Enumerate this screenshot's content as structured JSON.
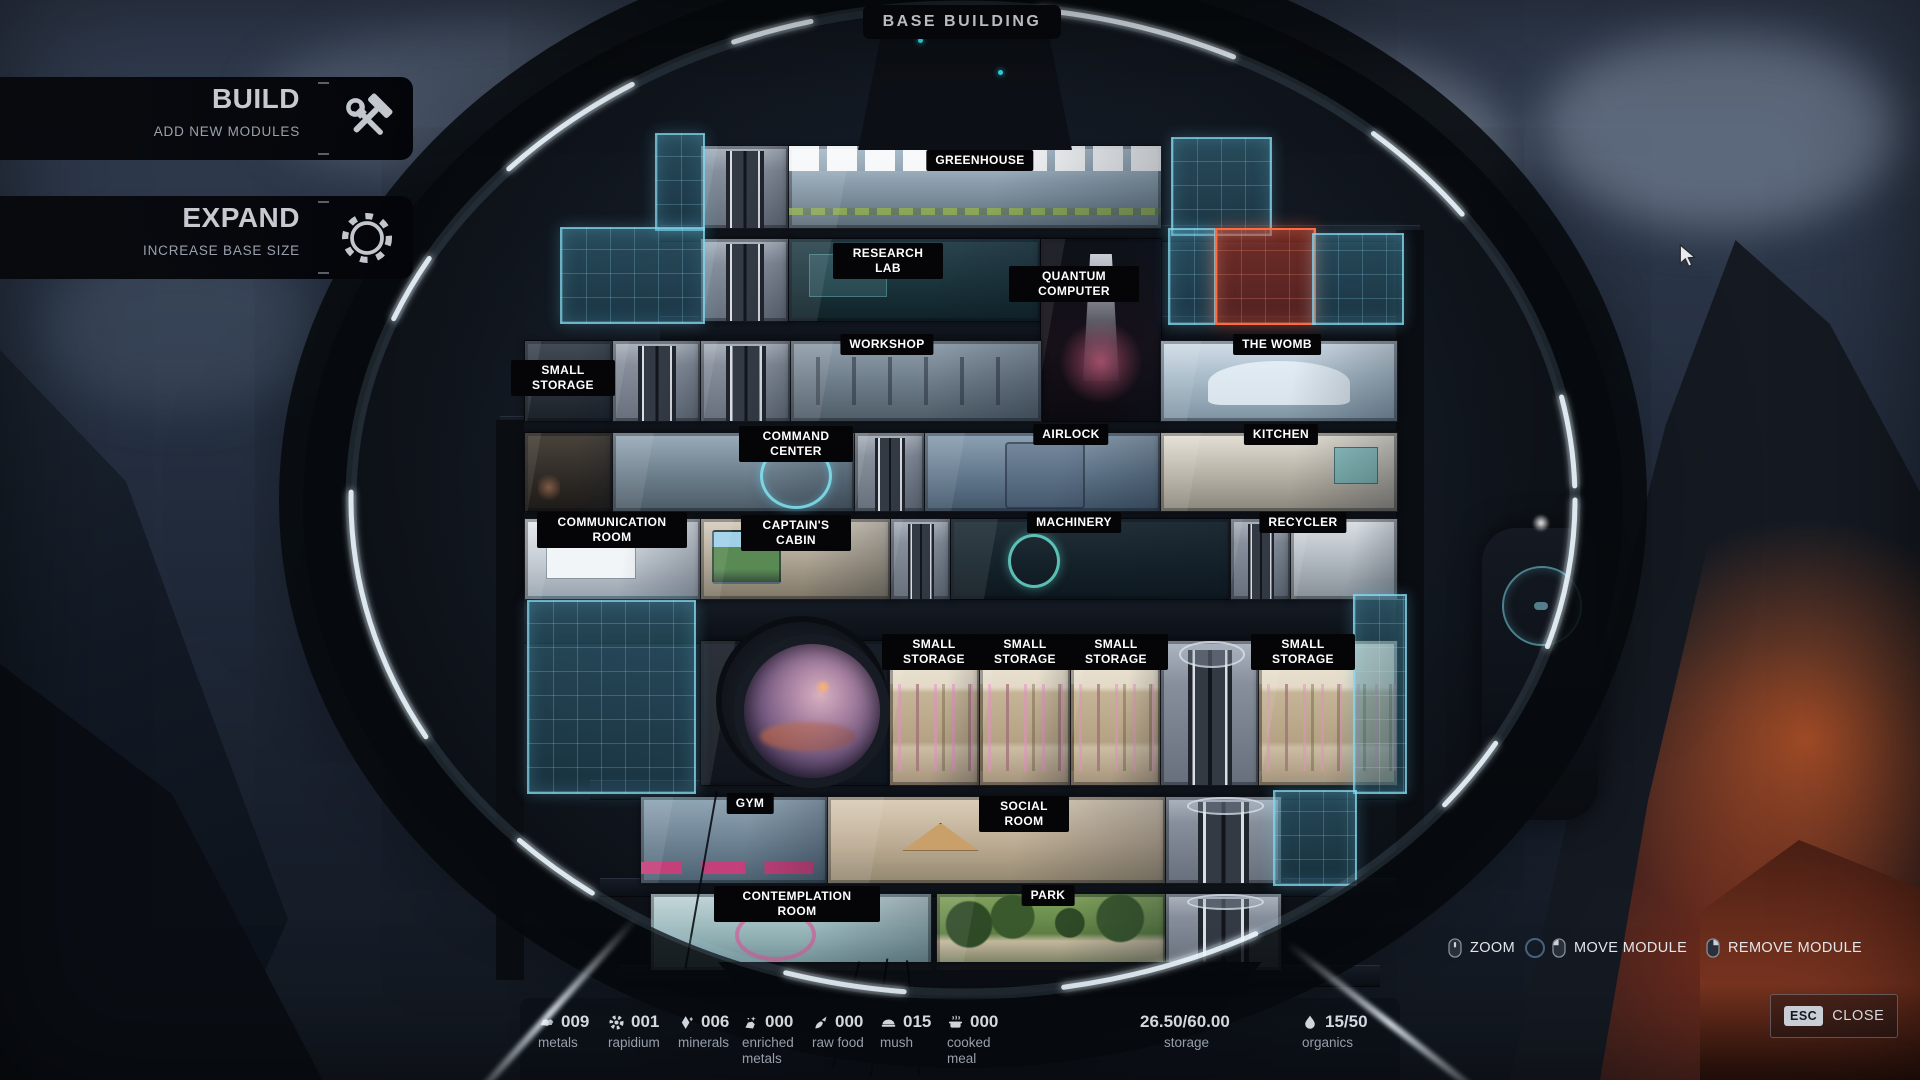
{
  "title": "BASE BUILDING",
  "left_menu": {
    "build": {
      "label": "BUILD",
      "sublabel": "ADD NEW MODULES",
      "icon": "hammer-wrench-icon"
    },
    "expand": {
      "label": "EXPAND",
      "sublabel": "INCREASE BASE SIZE",
      "icon": "gear-ring-icon"
    }
  },
  "modules": [
    {
      "label": "GREENHOUSE"
    },
    {
      "label": "RESEARCH LAB"
    },
    {
      "label": "QUANTUM COMPUTER"
    },
    {
      "label": "SMALL STORAGE"
    },
    {
      "label": "WORKSHOP"
    },
    {
      "label": "THE WOMB"
    },
    {
      "label": "COMMAND CENTER"
    },
    {
      "label": "AIRLOCK"
    },
    {
      "label": "KITCHEN"
    },
    {
      "label": "COMMUNICATION ROOM"
    },
    {
      "label": "CAPTAIN'S CABIN"
    },
    {
      "label": "MACHINERY"
    },
    {
      "label": "RECYCLER"
    },
    {
      "label": "SMALL STORAGE"
    },
    {
      "label": "SMALL STORAGE"
    },
    {
      "label": "SMALL STORAGE"
    },
    {
      "label": "SMALL STORAGE"
    },
    {
      "label": "GYM"
    },
    {
      "label": "SOCIAL ROOM"
    },
    {
      "label": "CONTEMPLATION ROOM"
    },
    {
      "label": "PARK"
    }
  ],
  "legend": [
    {
      "label": "ZOOM",
      "icon": "mouse-scroll-icon"
    },
    {
      "label": "MOVE MODULE",
      "icon": "mouse-left-icon"
    },
    {
      "label": "REMOVE MODULE",
      "icon": "mouse-right-icon"
    }
  ],
  "close": {
    "key": "ESC",
    "label": "CLOSE"
  },
  "resources": [
    {
      "label": "metals",
      "value": "009",
      "icon": "metals-icon"
    },
    {
      "label": "rapidium",
      "value": "001",
      "icon": "rapidium-icon"
    },
    {
      "label": "minerals",
      "value": "006",
      "icon": "minerals-icon"
    },
    {
      "label": "enriched metals",
      "value": "000",
      "icon": "enriched-metals-icon"
    },
    {
      "label": "raw food",
      "value": "000",
      "icon": "raw-food-icon"
    },
    {
      "label": "mush",
      "value": "015",
      "icon": "mush-icon"
    },
    {
      "label": "cooked meal",
      "value": "000",
      "icon": "cooked-meal-icon"
    }
  ],
  "storage": {
    "value": "26.50/60.00",
    "label": "storage"
  },
  "organics": {
    "value": "15/50",
    "label": "organics",
    "icon": "droplet-icon"
  },
  "colors": {
    "accent_cyan": "#6fd8ef",
    "alert_red": "#ff6a3e",
    "label_bg": "#050507",
    "ring_glow": "#eef8ff"
  }
}
